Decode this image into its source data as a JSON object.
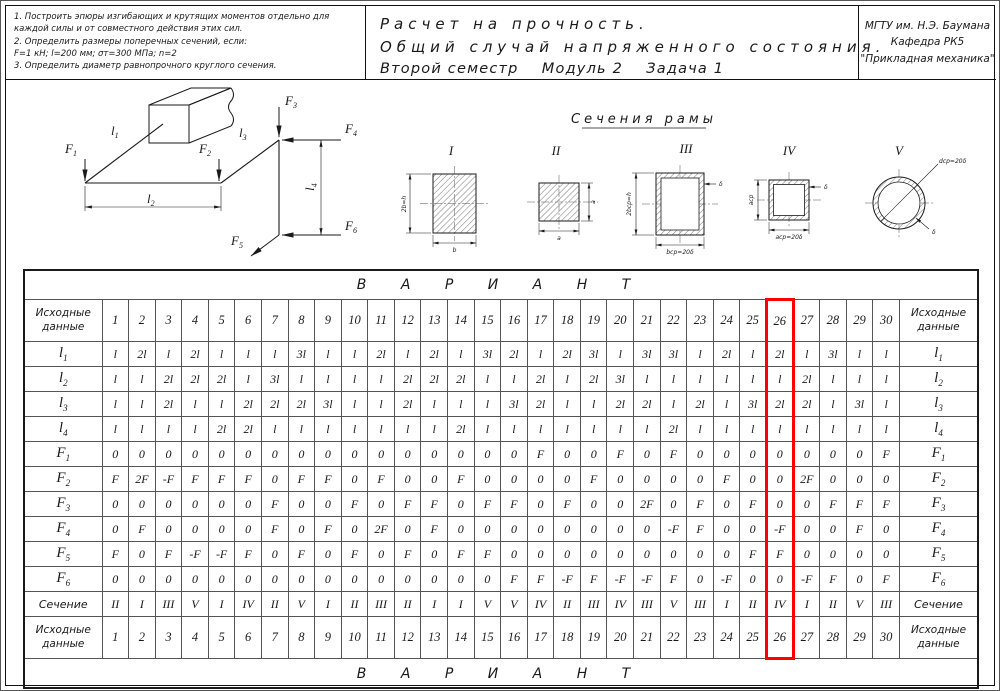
{
  "header": {
    "tasks": [
      "1. Построить эпюры изгибающих и крутящих моментов отдельно для каждой силы и от совместного действия этих сил.",
      "2. Определить размеры поперечных сечений, если:",
      "F=1 кН;  l=200 мм;  σт=300 МПа;  n=2",
      "3. Определить диаметр равнопрочного круглого сечения."
    ],
    "title_lines": [
      "Расчет на прочность.",
      "Общий случай напряженного состояния.",
      "Второй семестр    Модуль 2    Задача 1"
    ],
    "org_lines": [
      "МГТУ им. Н.Э. Баумана",
      "Кафедра РК5",
      "\"Прикладная механика\""
    ]
  },
  "diagram": {
    "labels": {
      "l1": {
        "main": "l",
        "sub": "1"
      },
      "l2": {
        "main": "l",
        "sub": "2"
      },
      "l3": {
        "main": "l",
        "sub": "3"
      },
      "l4": {
        "main": "l",
        "sub": "4"
      },
      "f1": {
        "main": "F",
        "sub": "1"
      },
      "f2": {
        "main": "F",
        "sub": "2"
      },
      "f3": {
        "main": "F",
        "sub": "3"
      },
      "f4": {
        "main": "F",
        "sub": "4"
      },
      "f5": {
        "main": "F",
        "sub": "5"
      },
      "f6": {
        "main": "F",
        "sub": "6"
      }
    }
  },
  "sections": {
    "title": "Сечения рамы",
    "items": [
      {
        "numeral": "I",
        "dims": [
          "2b=h",
          "b"
        ]
      },
      {
        "numeral": "II",
        "dims": [
          "a",
          "a"
        ]
      },
      {
        "numeral": "III",
        "dims": [
          "2bср=h",
          "bср=20δ",
          "δ"
        ]
      },
      {
        "numeral": "IV",
        "dims": [
          "aср",
          "aср=20δ",
          "δ"
        ]
      },
      {
        "numeral": "V",
        "dims": [
          "dср=20δ",
          "δ"
        ]
      }
    ]
  },
  "table": {
    "variant_label": "В А Р И А Н Т",
    "corner": [
      "Исходные",
      "данные"
    ],
    "columns": [
      "1",
      "2",
      "3",
      "4",
      "5",
      "6",
      "7",
      "8",
      "9",
      "10",
      "11",
      "12",
      "13",
      "14",
      "15",
      "16",
      "17",
      "18",
      "19",
      "20",
      "21",
      "22",
      "23",
      "24",
      "25",
      "26",
      "27",
      "28",
      "29",
      "30"
    ],
    "highlight_column": 26,
    "highlight_color": "#ff0000",
    "rows": [
      {
        "label": "l",
        "sub": "1",
        "values": [
          "l",
          "2l",
          "l",
          "2l",
          "l",
          "l",
          "l",
          "3l",
          "l",
          "l",
          "2l",
          "l",
          "2l",
          "l",
          "3l",
          "2l",
          "l",
          "2l",
          "3l",
          "l",
          "3l",
          "3l",
          "l",
          "2l",
          "l",
          "2l",
          "l",
          "3l",
          "l",
          "l"
        ]
      },
      {
        "label": "l",
        "sub": "2",
        "values": [
          "l",
          "l",
          "2l",
          "2l",
          "2l",
          "l",
          "3l",
          "l",
          "l",
          "l",
          "l",
          "2l",
          "2l",
          "2l",
          "l",
          "l",
          "2l",
          "l",
          "2l",
          "3l",
          "l",
          "l",
          "l",
          "l",
          "l",
          "l",
          "2l",
          "l",
          "l",
          "l"
        ]
      },
      {
        "label": "l",
        "sub": "3",
        "values": [
          "l",
          "l",
          "2l",
          "l",
          "l",
          "2l",
          "2l",
          "2l",
          "3l",
          "l",
          "l",
          "2l",
          "l",
          "l",
          "l",
          "3l",
          "2l",
          "l",
          "l",
          "2l",
          "2l",
          "l",
          "2l",
          "l",
          "3l",
          "2l",
          "2l",
          "l",
          "3l",
          "l"
        ]
      },
      {
        "label": "l",
        "sub": "4",
        "values": [
          "l",
          "l",
          "l",
          "l",
          "2l",
          "2l",
          "l",
          "l",
          "l",
          "l",
          "l",
          "l",
          "l",
          "2l",
          "l",
          "l",
          "l",
          "l",
          "l",
          "l",
          "l",
          "2l",
          "l",
          "l",
          "l",
          "l",
          "l",
          "l",
          "l",
          "l"
        ]
      },
      {
        "label": "F",
        "sub": "1",
        "values": [
          "0",
          "0",
          "0",
          "0",
          "0",
          "0",
          "0",
          "0",
          "0",
          "0",
          "0",
          "0",
          "0",
          "0",
          "0",
          "0",
          "F",
          "0",
          "0",
          "F",
          "0",
          "F",
          "0",
          "0",
          "0",
          "0",
          "0",
          "0",
          "0",
          "F"
        ]
      },
      {
        "label": "F",
        "sub": "2",
        "values": [
          "F",
          "2F",
          "-F",
          "F",
          "F",
          "F",
          "0",
          "F",
          "F",
          "0",
          "F",
          "0",
          "0",
          "F",
          "0",
          "0",
          "0",
          "0",
          "F",
          "0",
          "0",
          "0",
          "0",
          "F",
          "0",
          "0",
          "2F",
          "0",
          "0",
          "0"
        ]
      },
      {
        "label": "F",
        "sub": "3",
        "values": [
          "0",
          "0",
          "0",
          "0",
          "0",
          "0",
          "F",
          "0",
          "0",
          "F",
          "0",
          "F",
          "F",
          "0",
          "F",
          "F",
          "0",
          "F",
          "0",
          "0",
          "2F",
          "0",
          "F",
          "0",
          "F",
          "0",
          "0",
          "F",
          "F",
          "F"
        ]
      },
      {
        "label": "F",
        "sub": "4",
        "values": [
          "0",
          "F",
          "0",
          "0",
          "0",
          "0",
          "F",
          "0",
          "F",
          "0",
          "2F",
          "0",
          "F",
          "0",
          "0",
          "0",
          "0",
          "0",
          "0",
          "0",
          "0",
          "-F",
          "F",
          "0",
          "0",
          "-F",
          "0",
          "0",
          "F",
          "0"
        ]
      },
      {
        "label": "F",
        "sub": "5",
        "values": [
          "F",
          "0",
          "F",
          "-F",
          "-F",
          "F",
          "0",
          "F",
          "0",
          "F",
          "0",
          "F",
          "0",
          "F",
          "F",
          "0",
          "0",
          "0",
          "0",
          "0",
          "0",
          "0",
          "0",
          "0",
          "F",
          "F",
          "0",
          "0",
          "0",
          "0"
        ]
      },
      {
        "label": "F",
        "sub": "6",
        "values": [
          "0",
          "0",
          "0",
          "0",
          "0",
          "0",
          "0",
          "0",
          "0",
          "0",
          "0",
          "0",
          "0",
          "0",
          "0",
          "F",
          "F",
          "-F",
          "F",
          "-F",
          "-F",
          "F",
          "0",
          "-F",
          "0",
          "0",
          "-F",
          "F",
          "0",
          "F"
        ]
      },
      {
        "label": "Сечение",
        "sub": "",
        "values": [
          "II",
          "I",
          "III",
          "V",
          "I",
          "IV",
          "II",
          "V",
          "I",
          "II",
          "III",
          "II",
          "I",
          "I",
          "V",
          "V",
          "IV",
          "II",
          "III",
          "IV",
          "III",
          "V",
          "III",
          "I",
          "II",
          "IV",
          "I",
          "II",
          "V",
          "III"
        ]
      }
    ]
  }
}
